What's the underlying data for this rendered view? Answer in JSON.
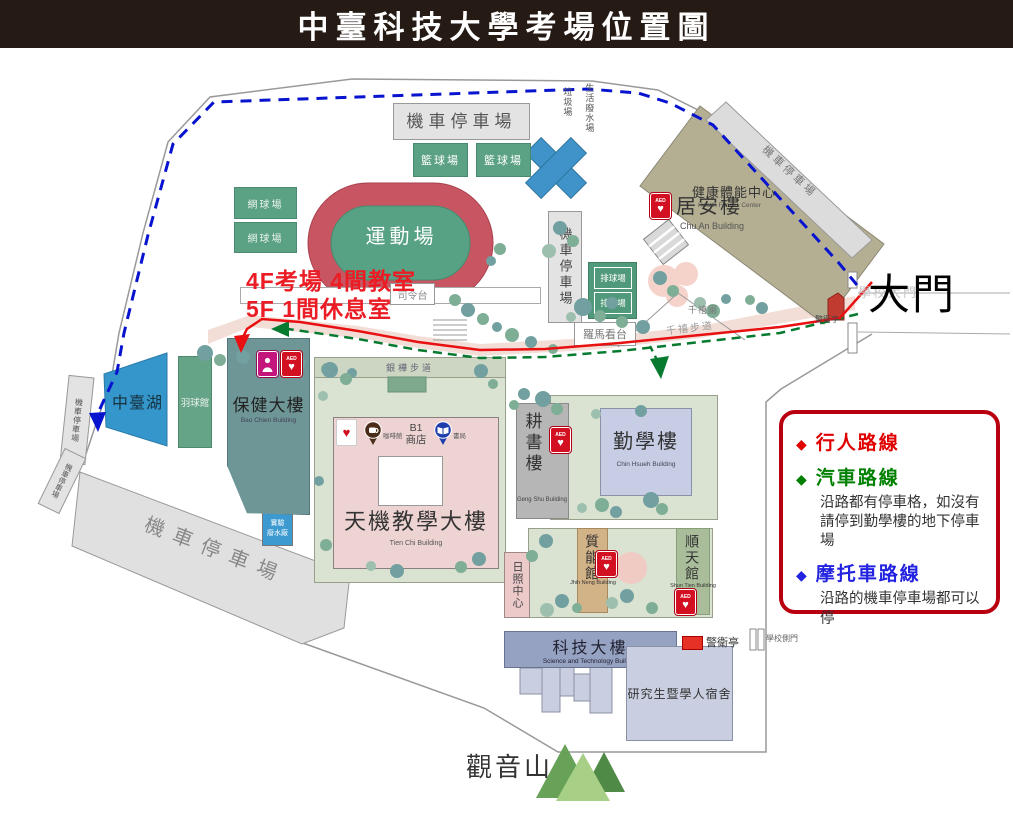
{
  "title": "中臺科技大學考場位置圖",
  "icons": {
    "diamond": "◆",
    "heart": "♥",
    "aed": "AED"
  },
  "annotation": {
    "line1": "4F考場 4間教室",
    "line2": "5F 1間休息室"
  },
  "legend": {
    "items": [
      {
        "label": "行人路線",
        "note": "",
        "color": "#e00000"
      },
      {
        "label": "汽車路線",
        "note": "沿路都有停車格，如沒有請停到勤學樓的地下停車場",
        "color": "#008000"
      },
      {
        "label": "摩托車路線",
        "note": "沿路的機車停車場都可以停",
        "color": "#2222e0"
      }
    ]
  },
  "gate": {
    "main": "大門",
    "main_faint": "學校大門",
    "guard": "警衛亭",
    "side_gate": "學校側門"
  },
  "labels": {
    "moto_parking": "機車停車場",
    "basketball": "籃球場",
    "tennis": "網球場",
    "volleyball": "排球場",
    "garbage": "垃圾場",
    "wastewater": "生活廢水場",
    "health_center": "健康體能中心",
    "health_center_en": "Health Fitness Center",
    "chu_an": "居安樓",
    "chu_an_en": "Chu An Building",
    "stadium": "運動場",
    "podium": "司令台",
    "roman_stand": "羅馬看台",
    "millennium_garden": "千禧園",
    "millennium_trail": "千禧步道",
    "lake": "中臺湖",
    "badminton": "羽球館",
    "bao_chien": "保健大樓",
    "bao_chien_en": "Bao Chien Building",
    "lab_wastewater": "實驗\n廢水廠",
    "tien_chi": "天機教學大樓",
    "tien_chi_en": "Tien Chi Building",
    "b1_shop": "B1\n商店",
    "coffee": "咖啡館",
    "bookstore": "書局",
    "grevillea_trail": "銀樺步道",
    "geng_shu": "耕書樓",
    "geng_shu_en": "Geng Shu Building",
    "chin_hsueh": "勤學樓",
    "chin_hsueh_en": "Chin Hsueh Building",
    "jhih_neng": "質能館",
    "jhih_neng_en": "Jhih Neng Building",
    "shun_tien": "順天館",
    "shun_tien_en": "Shun Tien Building",
    "day_care": "日照中心",
    "sci_tech": "科技大樓",
    "sci_tech_en": "Science and Technology Building",
    "dorm": "研究生暨學人宿舍",
    "guanyin": "觀音山",
    "guard_booth": "警衛亭"
  },
  "colors": {
    "route_pedestrian": "#e81010",
    "route_car": "#067a2e",
    "route_motorcycle": "#0713cf",
    "legend_border": "#b80010",
    "banner_bg": "#251b14"
  }
}
